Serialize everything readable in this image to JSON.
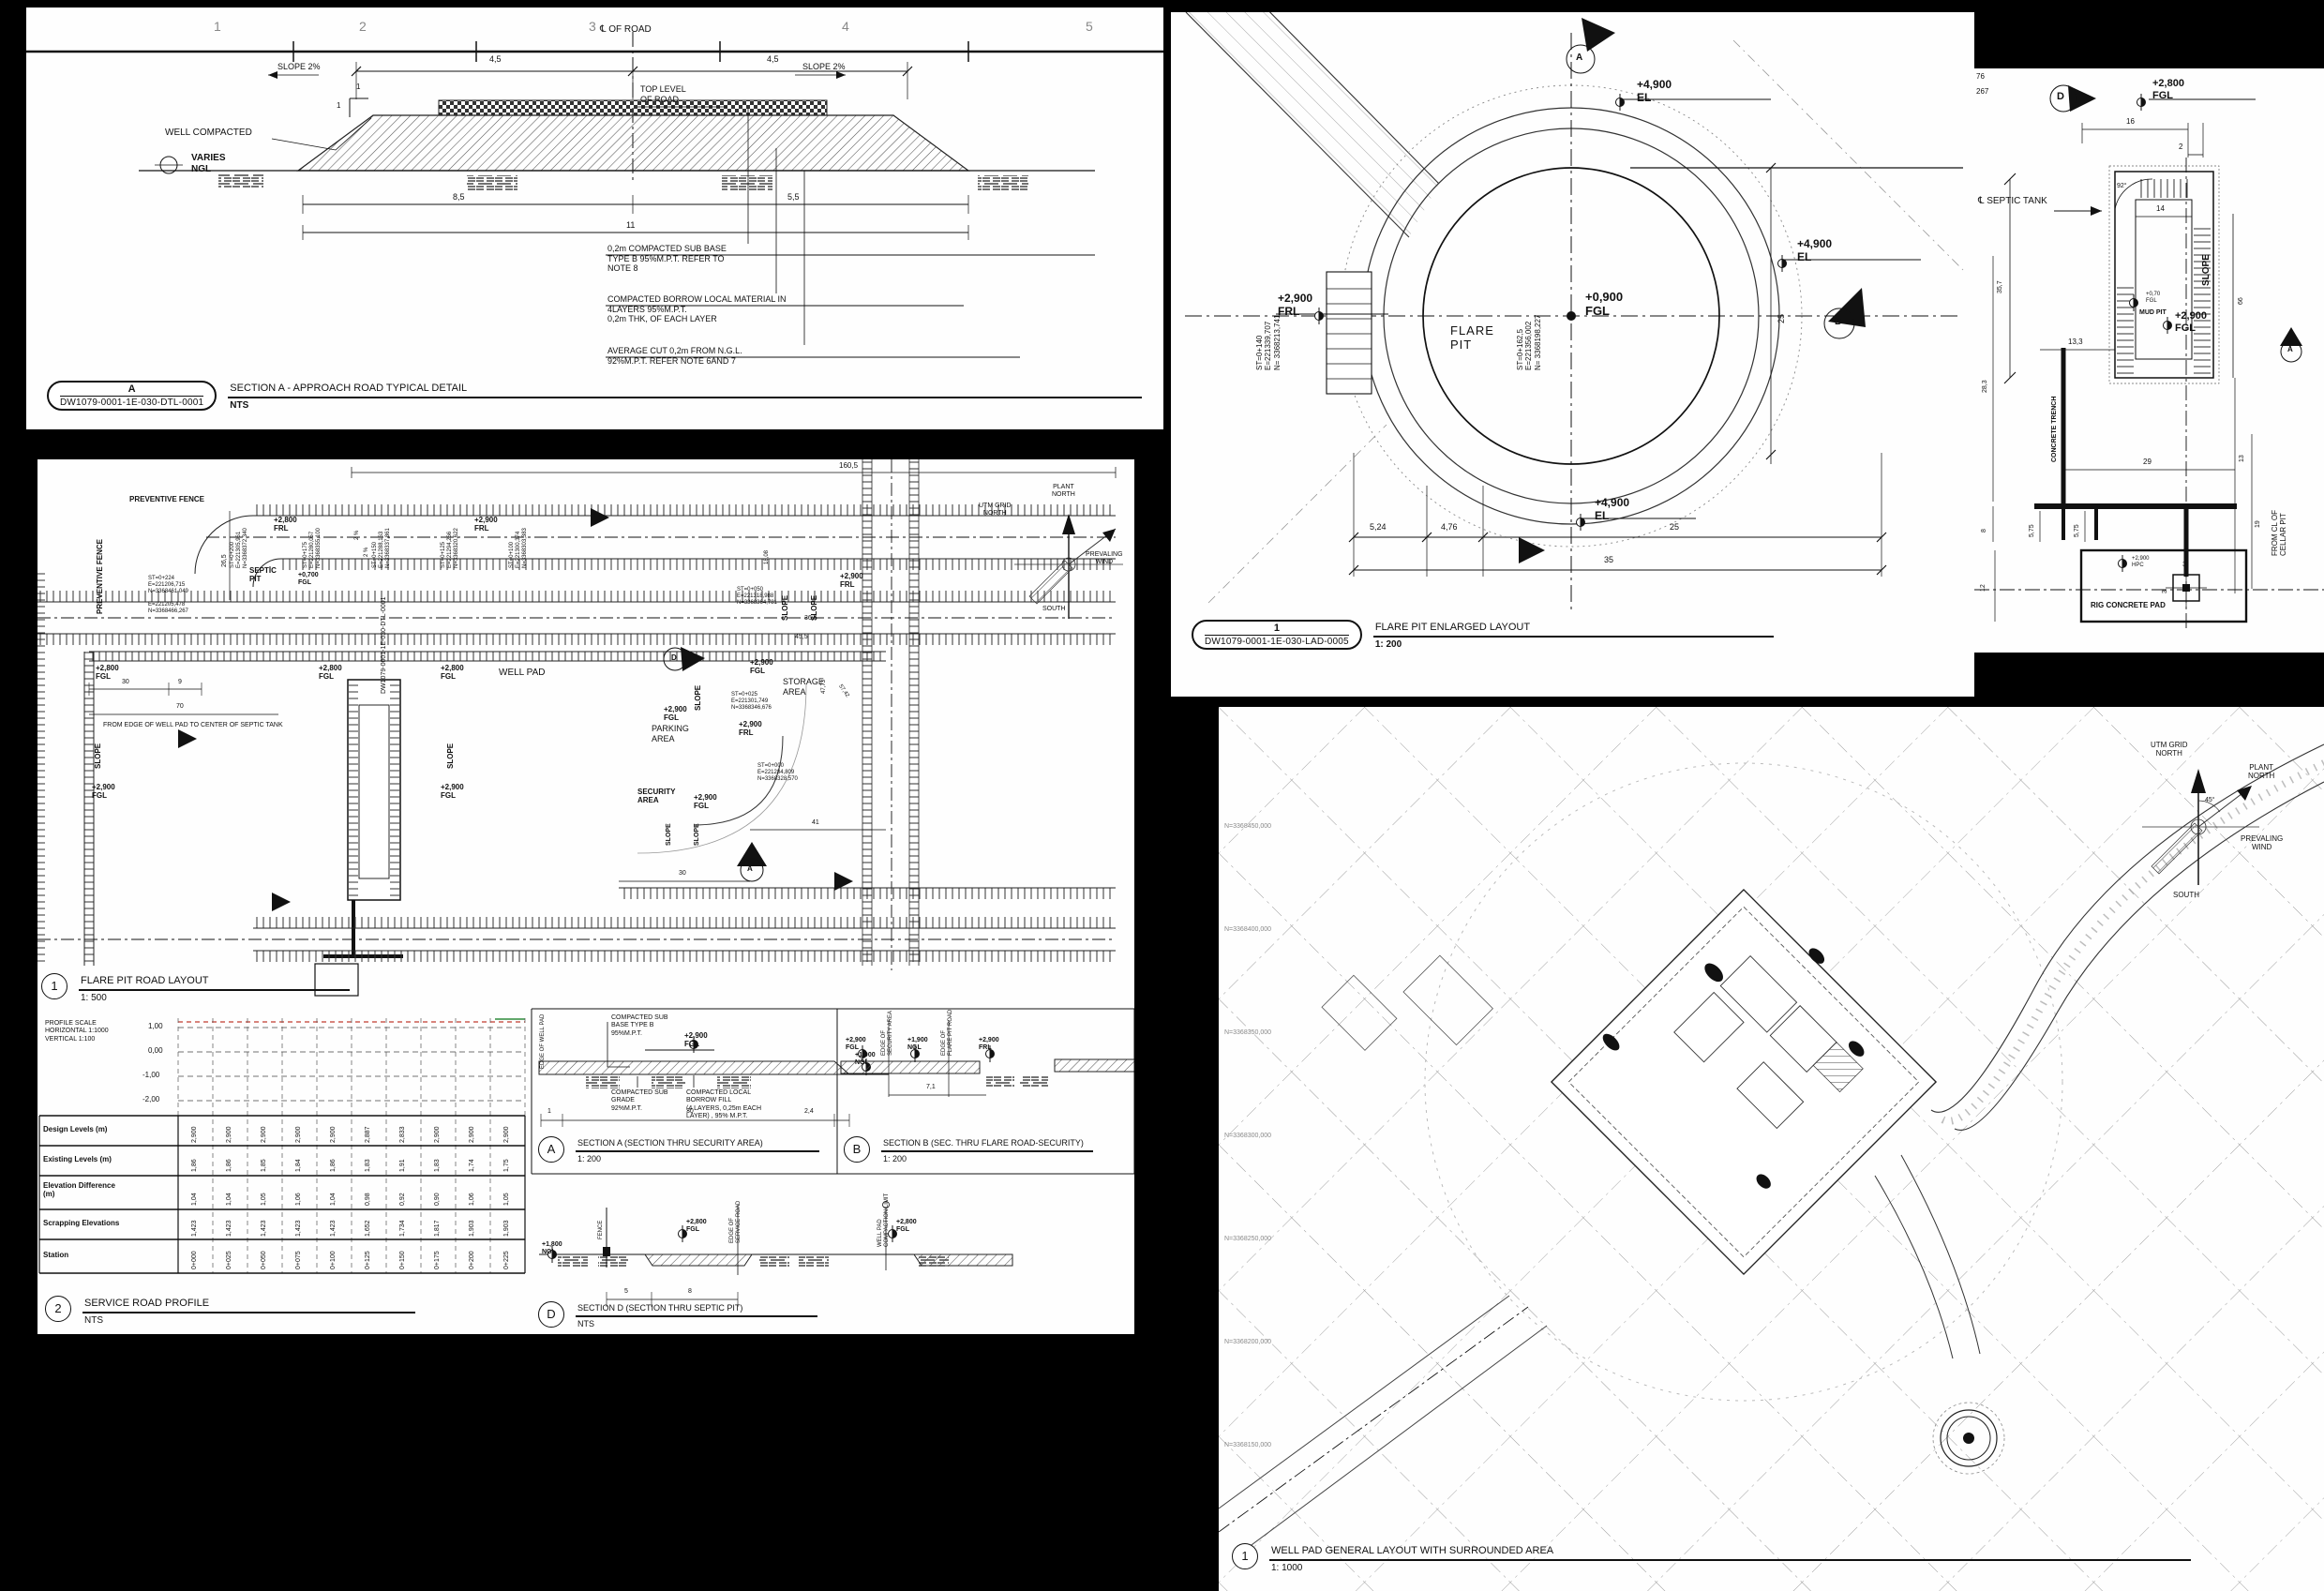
{
  "road_section": {
    "grid_numbers": [
      "1",
      "2",
      "3",
      "4",
      "5"
    ],
    "cl_of_road": "℄ OF ROAD",
    "dim_45_l": "4,5",
    "dim_45_r": "4,5",
    "well_compacted": "WELL COMPACTED",
    "slope_l": "SLOPE 2%",
    "slope_r": "SLOPE 2%",
    "top_level": "TOP LEVEL\nOF ROAD",
    "varies_ngl": "VARIES\nNGL",
    "one_a": "1",
    "one_b": "1",
    "dim_85": "8,5",
    "dim_55": "5,5",
    "dim_11": "11",
    "note_subbase": "0,2m COMPACTED SUB BASE\nTYPE B  95%M.P.T. REFER TO\nNOTE 8",
    "note_borrow": "COMPACTED BORROW LOCAL MATERIAL IN\n 4LAYERS  95%M.P.T.\n0,2m THK, OF EACH LAYER",
    "note_cut": "AVERAGE CUT 0,2m FROM N.G.L.\n92%M.P.T. REFER NOTE  6AND 7",
    "title": {
      "bubble": "A",
      "dwg_no": "DW1079-0001-1E-030-DTL-0001",
      "name": "SECTION A - APPROACH ROAD TYPICAL DETAIL",
      "scale": "NTS"
    }
  },
  "flare_pit": {
    "marker_a": "A",
    "marker_b": "B",
    "el_top": "+4,900\nEL",
    "el_right": "+4,900\nEL",
    "el_bottom": "+4,900\nEL",
    "frl_left": "+2,900\nFRL",
    "fgl_center": "+0,900\nFGL",
    "pit_name": "FLARE\nPIT",
    "st_center": "ST=0+162,5\nE=221356,002\nN= 3368198,227",
    "st_left": "ST=0+140\nE=221339,707\nN= 3368213,741",
    "dim_524": "5,24",
    "dim_476": "4,76",
    "dim_25_bottom": "25",
    "dim_35": "35",
    "dim_25_right": "25",
    "title": {
      "bubble": "1",
      "dwg_no": "DW1079-0001-1E-030-LAD-0005",
      "name": "FLARE PIT ENLARGED LAYOUT",
      "scale": "1: 200"
    }
  },
  "septic_detail": {
    "edge_76": "76",
    "edge_267": "267",
    "marker_d": "D",
    "marker_a": "A",
    "fgl_2800": "+2,800\nFGL",
    "dim_16": "16",
    "dim_2": "2",
    "dim_14": "14",
    "dim_357": "35,7",
    "dim_66": "66",
    "angle_92": "92°",
    "cl_septic_tank": "℄ SEPTIC TANK",
    "slope": "SLOPE",
    "mud_pit": "+0,70\nFGL",
    "mud_pit_name": "MUD PIT",
    "fgl_2900": "+2,900\nFGL",
    "dim_133": "13,3",
    "concrete_trench": "CONCRETE TRENCH",
    "dim_283": "28,3",
    "dim_29": "29",
    "dim_575_a": "5,75",
    "dim_575_b": "5,75",
    "dim_8": "8",
    "dim_13": "13",
    "dim_19": "19",
    "dim_12": "12",
    "dim_3_a": "3",
    "dim_3_b": "3",
    "from_cl_cellar": "FROM CL OF CELLAR PIT",
    "rig_pad": "RIG CONCRETE PAD",
    "hpc": "+2,900\nHPC"
  },
  "road_layout": {
    "dim_1605": "160,5",
    "dim_265": "26,5",
    "preventive_fence_h": "PREVENTIVE FENCE",
    "preventive_fence_v": "PREVENTIVE FENCE",
    "frl_2800": "+2,800\nFRL",
    "frl_2900": "+2,900\nFRL",
    "pct_a": "2 %",
    "pct_b": "2 %",
    "st_200": "ST=0+200\nE=221305,961\nN=3368372,340",
    "st_175": "ST=0+175\nE=221280,057\nN=3368355,100",
    "st_150": "ST=0+150\nE=221288,163\nN=3368337,861",
    "st_125": "ST=0+125\nE=221294,266\nN=3368320,622",
    "st_100": "ST=0+100\nE=221300,374\nN=3368303,383",
    "st_224": "ST=0+224\nE=221206,715\nN=3368461,049",
    "coord_extra": "E=221205,478\nN=3368466,267",
    "septic_pit": "SEPTİC\nPIT",
    "fgl_0700": "+0,700\nFGL",
    "fgl_2800_a": "+2,800\nFGL",
    "fgl_2800_b": "+2,800\nFGL",
    "fgl_2800_c": "+2,800\nFGL",
    "well_pad": "WELL PAD",
    "dim_30_a": "30",
    "dim_9": "9",
    "dim_70": "70",
    "from_edge": "FROM EDGE OF WELL PAD TO CENTER OF SEPTIC TANK",
    "slope_a": "SLOPE",
    "slope_b": "SLOPE",
    "slope_c": "SLOPE",
    "slope_d": "SLOPE",
    "slope_e": "SLOPE",
    "slope_f": "SLOPE",
    "slope_g": "SLOPE",
    "fgl_2900_a": "+2,900\nFGL",
    "fgl_2900_b": "+2,900\nFGL",
    "fgl_2900_c": "+2,900\nFGL",
    "fgl_2900_d": "+2,900\nFGL",
    "frl_2900_b": "+2,900\nFRL",
    "frl_2900_c": "+2,900\nFRL",
    "storage_area": "STORAGE\nAREA",
    "parking_area": "PARKING\nAREA",
    "security_area": "SECURITY\nAREA",
    "st_050": "ST=0+050\nE=221318,988\nN=3368364,781",
    "st_025": "ST=0+025\nE=221301,749\nN=3368346,676",
    "st_000": "ST=0+000\nE=221284,809\nN=3368328,570",
    "dim_1808": "18,08",
    "dim_365": "36,5",
    "dim_455": "45,5",
    "dim_4773": "47,73",
    "dim_5742": "57,42",
    "dim_30_b": "30",
    "dim_41": "41",
    "dwg_ref": "DW1079-0001-1E-030-DTL-0001",
    "marker_a": "A",
    "marker_d": "D",
    "compass": {
      "plant_north": "PLANT\nNORTH",
      "utm_north": "UTM GRID\nNORTH",
      "wind": "PREVALING\nWIND",
      "south": "SOUTH"
    },
    "title": {
      "bubble": "1",
      "name": "FLARE PIT ROAD LAYOUT",
      "scale": "1: 500"
    }
  },
  "profile": {
    "scale_note": "PROFILE SCALE\nHORIZONTAL 1:1000\nVERTICAL 1:100",
    "y_ticks": [
      "1,00",
      "0,00",
      "-1,00",
      "-2,00"
    ],
    "rows": [
      {
        "label": "Design Levels (m)",
        "values": [
          "2,900",
          "2,900",
          "2,900",
          "2,900",
          "2,900",
          "2,887",
          "2,833",
          "2,900",
          "2,900",
          "2,900"
        ]
      },
      {
        "label": "Existing Levels (m)",
        "values": [
          "1,86",
          "1,86",
          "1,85",
          "1,84",
          "1,86",
          "1,83",
          "1,91",
          "1,83",
          "1,74",
          "1,75"
        ]
      },
      {
        "label": "Elevation Difference\n(m)",
        "values": [
          "1,04",
          "1,04",
          "1,05",
          "1,06",
          "1,04",
          "0,98",
          "0,92",
          "0,90",
          "1,06",
          "1,05"
        ]
      },
      {
        "label": "Scrapping Elevations",
        "values": [
          "1,423",
          "1,423",
          "1,423",
          "1,423",
          "1,423",
          "1,652",
          "1,734",
          "1,817",
          "1,903",
          "1,903"
        ]
      },
      {
        "label": "Station",
        "values": [
          "0+000",
          "0+025",
          "0+050",
          "0+075",
          "0+100",
          "0+125",
          "0+150",
          "0+175",
          "0+200",
          "0+225"
        ]
      }
    ],
    "title": {
      "bubble": "2",
      "name": "SERVICE ROAD PROFILE",
      "scale": "NTS"
    }
  },
  "sections": {
    "a": {
      "bubble": "A",
      "name": "SECTION A (SECTION THRU SECURITY AREA)",
      "scale": "1: 200",
      "note_subbase": "COMPACTED SUB\nBASE TYPE B\n95%M.P.T.",
      "fgl": "+2,900\nFGL",
      "note_subgrade": "COMPACTED SUB\nGRADE\n92%M.P.T.",
      "note_borrow": "COMPACTED LOCAL\nBORROW FILL\n(4 LAYERS, 0,25m EACH\nLAYER) , 95% M.P.T.",
      "ngl": "+1,900\nNGL",
      "edge_well_pad": "EDGE OF WELL PAD",
      "dim_1": "1",
      "dim_30": "30",
      "dim_24": "2,4"
    },
    "b": {
      "bubble": "B",
      "name": "SECTION B (SEC. THRU FLARE ROAD-SECURITY)",
      "scale": "1: 200",
      "fgl": "+2,900\nFGL",
      "edge_security": "EDGE OF\nSECURITY AREA",
      "ngl": "+1,900\nNGL",
      "edge_flare": "EDGE OF\nFLARE PIT ROAD",
      "frl": "+2,900\nFRL",
      "dim_71": "7,1"
    },
    "d": {
      "bubble": "D",
      "name": "SECTION D (SECTION THRU SEPTIC PIT)",
      "scale": "NTS",
      "ngl": "+1,800\nNGL",
      "fence": "FENCE",
      "fgl_l": "+2,800\nFGL",
      "edge_service": "EDGE OF\nSERVICE ROAD",
      "well_pad_limit": "WELL PAD\nCOMPACTION LIMIT",
      "fgl_r": "+2,800\nFGL",
      "dim_5": "5",
      "dim_8": "8"
    }
  },
  "site_plan": {
    "compass": {
      "utm_north": "UTM GRID\nNORTH",
      "plant_north": "PLANT\nNORTH",
      "angle": "45°",
      "wind": "PREVALING\nWIND",
      "south": "SOUTH"
    },
    "grid_labels": [
      "N=3368450,000",
      "N=3368400,000",
      "N=3368350,000",
      "N=3368300,000",
      "N=3368250,000",
      "N=3368200,000",
      "N=3368150,000"
    ],
    "title": {
      "bubble": "1",
      "name": "WELL PAD GENERAL LAYOUT WITH SURROUNDED AREA",
      "scale": "1: 1000"
    }
  }
}
